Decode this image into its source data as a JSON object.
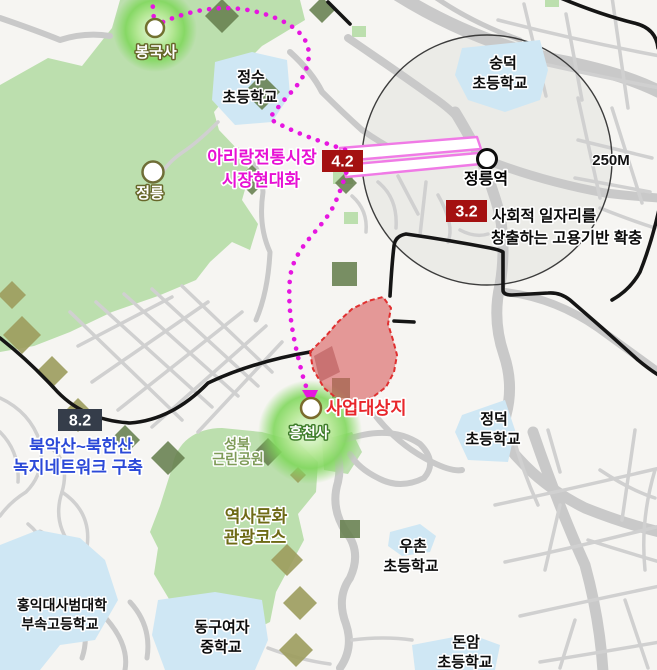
{
  "badges": {
    "market_number": "4.2",
    "jobs_number": "3.2",
    "greenway_number": "8.2"
  },
  "annotations": {
    "market_line1": "아리랑전통시장",
    "market_line2": "시장현대화",
    "jobs_line1": "사회적 일자리를",
    "jobs_line2": "창출하는 고용기반 확충",
    "greenway_line1": "북악산~북한산",
    "greenway_line2": "녹지네트워크 구축",
    "heritage_line1": "역사문화",
    "heritage_line2": "관광코스",
    "site_label": "사업대상지",
    "scale_label": "250M"
  },
  "places": {
    "bongguksa": "봉국사",
    "jeongneung": "정릉",
    "station": "정릉역",
    "heungcheonsa": "흥천사",
    "park_line1": "성북",
    "park_line2": "근린공원",
    "jeongsu_line1": "정수",
    "jeongsu_line2": "초등학교",
    "sungdeok_line1": "숭덕",
    "sungdeok_line2": "초등학교",
    "jeongdeok_line1": "정덕",
    "jeongdeok_line2": "초등학교",
    "uchon_line1": "우촌",
    "uchon_line2": "초등학교",
    "donam_line1": "돈암",
    "donam_line2": "초등학교",
    "donggu_line1": "동구여자",
    "donggu_line2": "중학교",
    "hongik_line1": "홍익대사범대학",
    "hongik_line2": "부속고등학교"
  },
  "colors": {
    "badge_red": "#a41111",
    "badge_navy": "#353d4a",
    "route_magenta": "#e616e0",
    "market_text": "#e711d4",
    "greenway_text": "#2b49d8",
    "site_text": "#e8262b",
    "heritage_text": "#6e6a16",
    "park_name_text": "#7e9b58",
    "site_fill": "#d96060",
    "park_green": "#bcdfae",
    "school_blue": "#cfe7f4",
    "road_gray": "#c9c9c9",
    "highlight_pink": "#f07ae6"
  }
}
